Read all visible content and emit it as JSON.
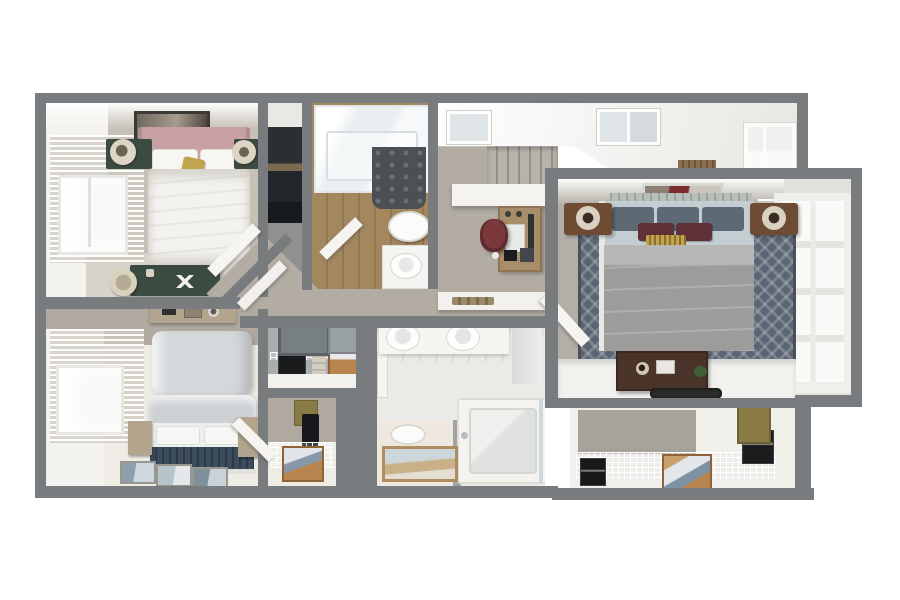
{
  "scene": {
    "title": "3D dollhouse-style floor plan render, upper floor, top-down view",
    "rooms": [
      {
        "id": "bedroom-1",
        "label": "Bedroom — top left",
        "furniture": [
          "double bed with blush throw",
          "framed art above bed",
          "two dark-green nightstands",
          "two cream table lamps",
          "window with venetian blinds",
          "green writing desk",
          "round stool"
        ]
      },
      {
        "id": "wardrobe-nook",
        "label": "Wardrobe nook",
        "furniture": [
          "dark wardrobe with shelves"
        ]
      },
      {
        "id": "bathroom-1",
        "label": "Bathroom — top",
        "furniture": [
          "shower tub with glass",
          "dark shower curtain",
          "toilet",
          "sink vanity",
          "wood plank floor",
          "open door"
        ]
      },
      {
        "id": "hallway",
        "label": "Hallway landing",
        "furniture": [
          "staircase going down",
          "white half wall",
          "wood desk with laptop",
          "maroon office chair",
          "two ceiling skylights",
          "hall window",
          "wood vent grille",
          "ledge with tray"
        ]
      },
      {
        "id": "master-bedroom",
        "label": "Master bedroom",
        "furniture": [
          "king bed with gray duvet",
          "blue-gray pillows",
          "maroon accent cushions",
          "gold runner cushion",
          "patterned blue area rug",
          "two wood nightstands with lamps",
          "framed art above bed",
          "picture windows with blinds",
          "white dresser counter",
          "dark wood chest",
          "dark vanity tray",
          "open door"
        ]
      },
      {
        "id": "bedroom-2",
        "label": "Bedroom — bottom left",
        "furniture": [
          "upholstered bed with tall pillows",
          "navy foot runner",
          "two wood nightstands",
          "three floor mats",
          "dresser with decor items",
          "window with venetian blinds",
          "open door"
        ]
      },
      {
        "id": "linen-closet",
        "label": "Linen closet",
        "furniture": [
          "two wall screens",
          "wire shelf",
          "black storage box",
          "folded towels",
          "wicker basket"
        ]
      },
      {
        "id": "utility-closet",
        "label": "Utility closet",
        "furniture": [
          "wire shelving",
          "wicker laundry basket",
          "hanging dark garment",
          "tan storage box"
        ]
      },
      {
        "id": "bathroom-2",
        "label": "Main bathroom",
        "furniture": [
          "double sink vanity",
          "small plant",
          "bathtub",
          "glass screen",
          "marble tile walls"
        ]
      },
      {
        "id": "wc",
        "label": "Toilet room",
        "furniture": [
          "toilet",
          "framed floor mat"
        ]
      },
      {
        "id": "walk-in-closet",
        "label": "Walk-in closet",
        "furniture": [
          "wire shelving run",
          "wicker basket with clothes",
          "two black storage boxes",
          "tan access panel"
        ]
      }
    ]
  },
  "palette": {
    "bg": "#ffffff",
    "wall": "#797c7e",
    "ceiling": "#f5f5f3",
    "hallCarpet": "#b2aca3",
    "carpet1": "#c6c0b7",
    "carpet2": "#b3aea6",
    "floorWhite": "#efece6",
    "wallFace": "#f3f2ee",
    "taupe": "#b1aaa0",
    "woodFloor": "#a3875f",
    "wood": "#a78d68",
    "woodDark": "#6e4b33",
    "green": "#3c4b41",
    "blush": "#c7a0a4",
    "maroon": "#5e3038",
    "navy": "#3d4c5c",
    "rug": "#5b6572",
    "bedGray": "#9c9c9a",
    "pillow": "#5d6974",
    "gold": "#c2a44e",
    "basket": "#b9854e",
    "black": "#1a1b1d",
    "sage": "#b6bfb9",
    "tan": "#8a7a45",
    "glass": "#f8faf9"
  }
}
